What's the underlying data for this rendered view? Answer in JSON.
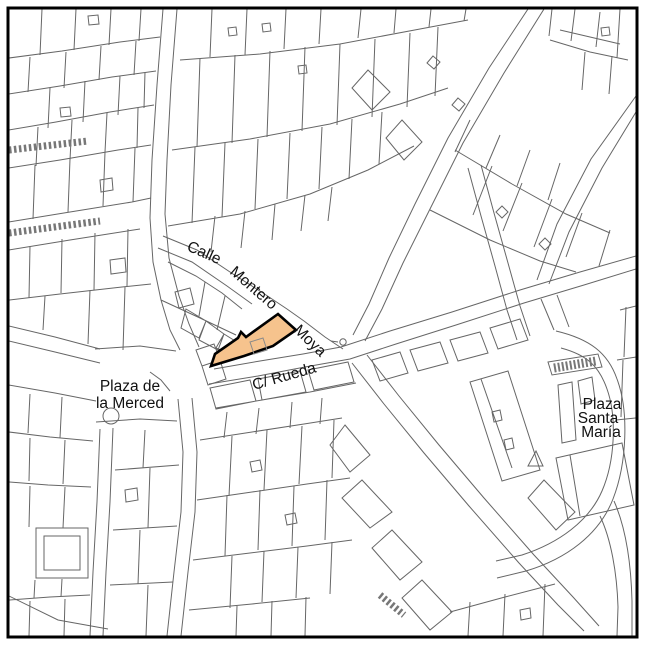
{
  "map": {
    "street_labels": {
      "montero_moya": {
        "word1": "Calle",
        "word2": "Montero",
        "word3": "Moya"
      },
      "rueda": "C/ Rueda"
    },
    "plaza_labels": {
      "merced": {
        "line1": "Plaza de",
        "line2": "la Merced"
      },
      "santa_maria": {
        "line1": "Plaza",
        "line2": "Santa",
        "line3": "María"
      }
    },
    "highlighted_parcel": {
      "fill_color": "#F6C38D",
      "outline_color": "#000000"
    },
    "style": {
      "background_color": "#FFFFFF",
      "building_line_color": "#666666",
      "frame_color": "#000000",
      "label_color": "#111111"
    }
  }
}
